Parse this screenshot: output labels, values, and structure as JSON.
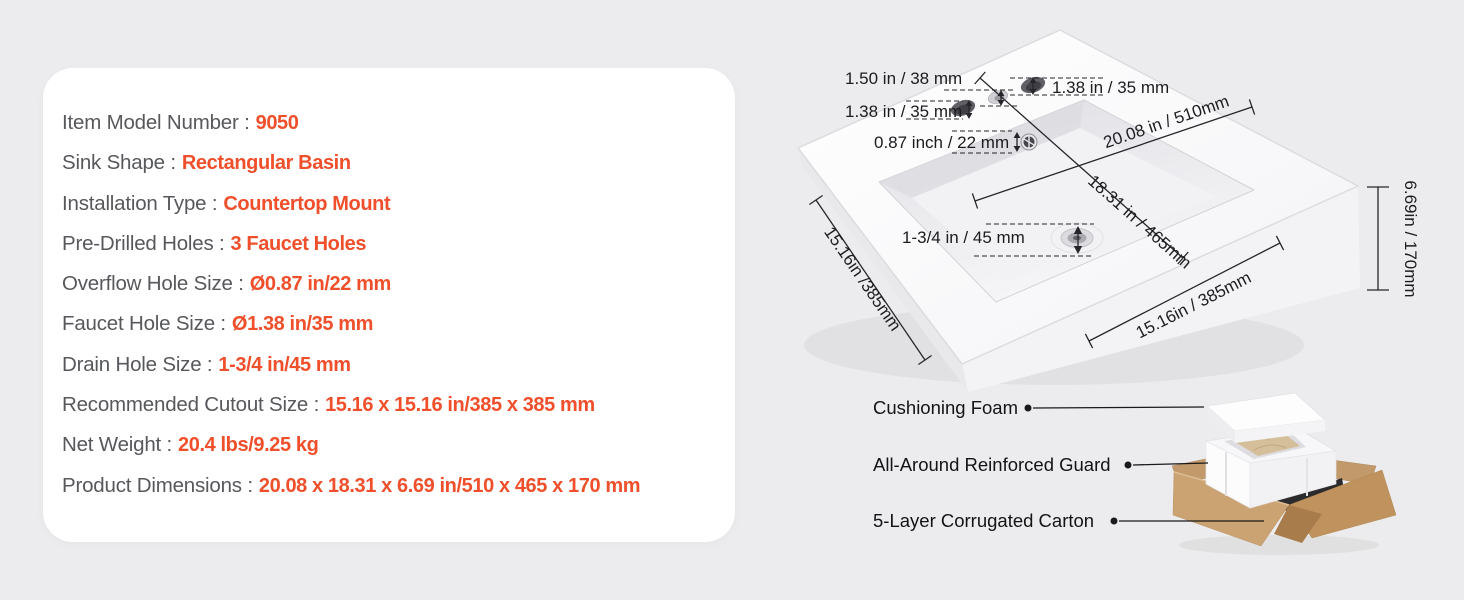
{
  "page": {
    "background": "#ececee"
  },
  "colors": {
    "accent_orange": "#F04F2B",
    "label_gray": "#57585C",
    "dimension_line": "#26262a",
    "carton_tan": "#C59A67"
  },
  "spec_card": {
    "rows": [
      {
        "label": "Item Model Number :",
        "value": "9050"
      },
      {
        "label": "Sink Shape :",
        "value": "Rectangular Basin"
      },
      {
        "label": "Installation Type :",
        "value": "Countertop Mount"
      },
      {
        "label": "Pre-Drilled Holes :",
        "value": "3 Faucet Holes"
      },
      {
        "label": "Overflow Hole Size :",
        "value": "Ø0.87 in/22 mm"
      },
      {
        "label": "Faucet Hole Size :",
        "value": "Ø1.38 in/35 mm"
      },
      {
        "label": "Drain Hole Size :",
        "value": "1-3/4 in/45 mm"
      },
      {
        "label": "Recommended Cutout Size :",
        "value": "15.16 x 15.16 in/385 x 385 mm"
      },
      {
        "label": "Net Weight :",
        "value": "20.4 lbs/9.25 kg"
      },
      {
        "label": "Product Dimensions :",
        "value": "20.08 x 18.31 x 6.69 in/510 x 465 x 170 mm"
      }
    ]
  },
  "sink": {
    "dim_hole_spacing": "1.50 in / 38 mm",
    "dim_faucet_left": "1.38 in / 35 mm",
    "dim_faucet_right": "1.38 in / 35 mm",
    "dim_overflow": "0.87 inch / 22 mm",
    "dim_drain": "1-3/4 in / 45 mm",
    "dim_width": "20.08 in / 510mm",
    "dim_depth": "18.31 in / 465mm",
    "dim_cutout_left": "15.16in /385mm",
    "dim_cutout_bottom": "15.16in / 385mm",
    "dim_height": "6.69in / 170mm"
  },
  "packaging": {
    "labels": [
      "Cushioning Foam",
      "All-Around Reinforced Guard",
      "5-Layer Corrugated Carton"
    ]
  }
}
